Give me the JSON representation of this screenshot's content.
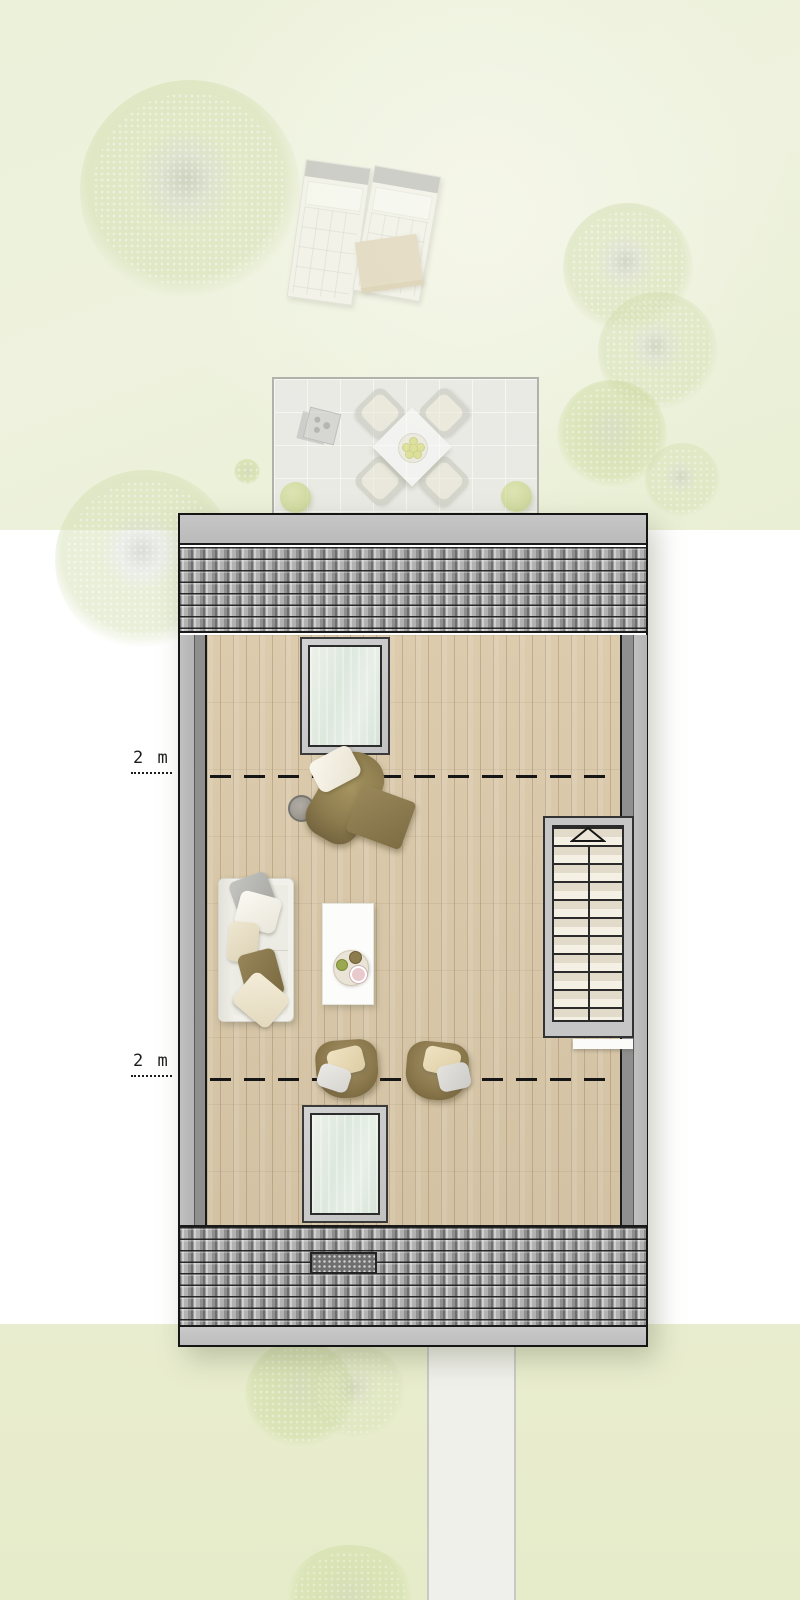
{
  "scene": {
    "kind": "architectural-floor-plan",
    "description": "Top-down attic floor plan with tiled roof strips, wood floor, two skylights, staircase, lounge furniture, garden with trees, patio dining set, sun loungers and footpath"
  },
  "labels": {
    "upper_dim": "2 m",
    "lower_dim": "2 m"
  },
  "palette": {
    "garden_green_top": "#edf1da",
    "garden_green_bottom": "#e8edcf",
    "roof_tile_gray": "#a8a8a8",
    "ridge_gray": "#c0c0c0",
    "wall_light_gray": "#bcbcbc",
    "wall_dark_gray": "#8f8f8f",
    "wood_floor": "#d8c7a9",
    "skylight_glass": "#e2ebe2",
    "stair_tread": "#ece6d9",
    "olive_upholstery": "#8d7b4f",
    "sofa_white": "#f1f0ea",
    "bush_green": "#c2d070",
    "path_gray": "#f1f1ef",
    "section_line": "#161616"
  },
  "inventory": {
    "outdoor": [
      "large-tree",
      "side-trees",
      "sun-lounger-left",
      "sun-lounger-right",
      "patio-terrace",
      "dining-table",
      "dining-chairs",
      "lantern",
      "bushes",
      "footpath",
      "bottom-trees"
    ],
    "indoor": [
      "top-roof",
      "bottom-roof",
      "skylight-top",
      "skylight-bottom",
      "staircase",
      "up-arrow",
      "chaise-longue",
      "ottoman",
      "pouf",
      "sofa",
      "coffee-table",
      "armchair-left",
      "armchair-right",
      "roof-vent"
    ],
    "annotations": [
      "dimension-line-upper",
      "dimension-line-lower"
    ]
  }
}
